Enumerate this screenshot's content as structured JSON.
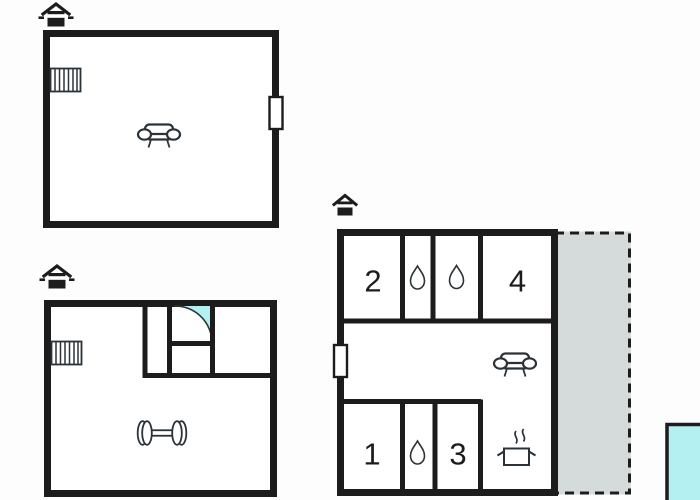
{
  "canvas": {
    "width": 700,
    "height": 500,
    "background": "#fdfdfd"
  },
  "colors": {
    "wall": "#1c1c1c",
    "water": "#b4f0f2",
    "terrace": "#d5dbda",
    "icon_outline": "#2c3338",
    "bg": "#fdfdfd"
  },
  "plans": {
    "upper_floor": {
      "icons": [
        "house-icon",
        "stairs-icon",
        "sofa-icon",
        "door-marker"
      ],
      "rooms": {}
    },
    "basement": {
      "icons": [
        "house-icon",
        "stairs-icon",
        "door-swing-icon",
        "dumbbell-icon"
      ],
      "rooms": {}
    },
    "ground_floor": {
      "icons": [
        "house-icon",
        "water-drop-icon",
        "water-drop-icon",
        "water-drop-icon",
        "sofa-icon",
        "cooking-pot-icon",
        "door-marker",
        "terrace-area",
        "pool-area"
      ],
      "rooms": {
        "r2": "2",
        "r4": "4",
        "r1": "1",
        "r3": "3"
      }
    }
  }
}
